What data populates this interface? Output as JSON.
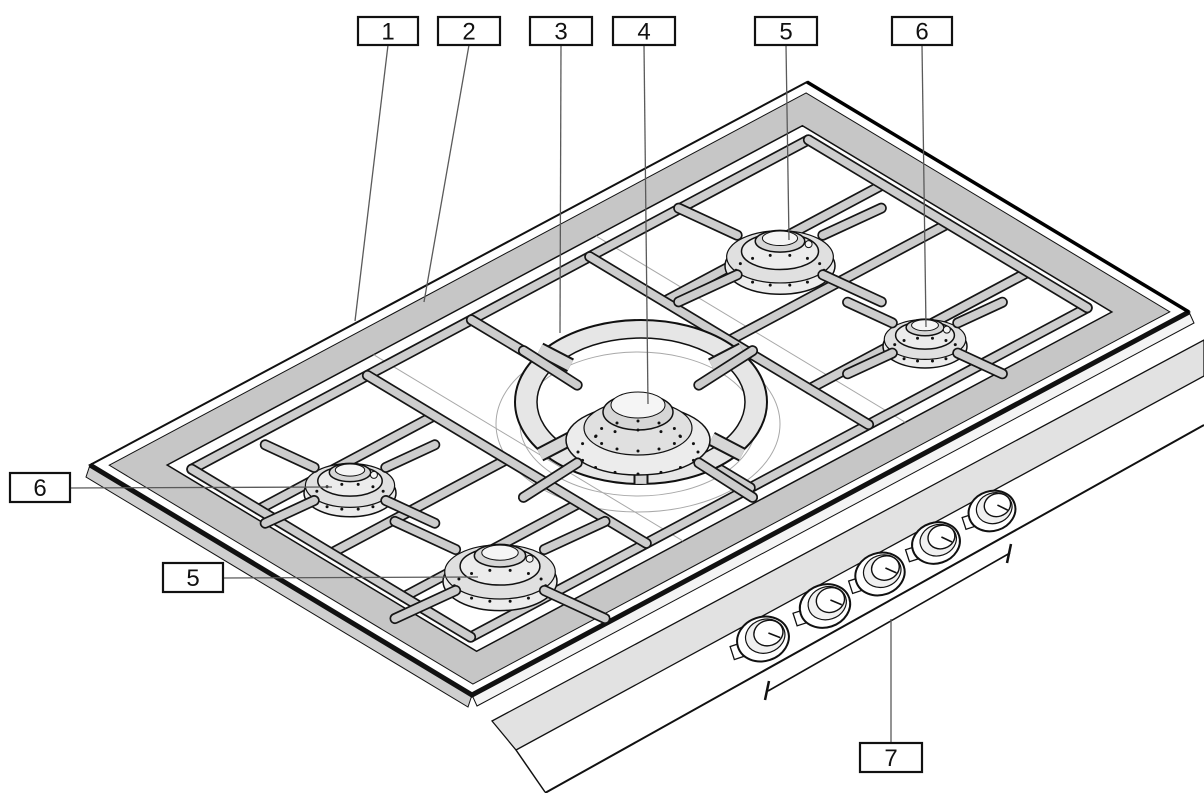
{
  "figure": {
    "subject": "gas cooktop parts diagram",
    "style": "black and white line illustration",
    "background_color": "#ffffff",
    "line_color": "#111111",
    "rim_color": "#c6c6c6",
    "grate_color": "#cdcdcd",
    "burner_count": 5,
    "knob_count": 5
  },
  "callouts": [
    {
      "label": "1",
      "box": {
        "x": 358,
        "y": 17,
        "w": 60,
        "h": 28
      },
      "leader": {
        "x1": 388,
        "y1": 45,
        "x2": 355,
        "y2": 321
      }
    },
    {
      "label": "2",
      "box": {
        "x": 438,
        "y": 17,
        "w": 62,
        "h": 28
      },
      "leader": {
        "x1": 469,
        "y1": 45,
        "x2": 424,
        "y2": 302
      }
    },
    {
      "label": "3",
      "box": {
        "x": 530,
        "y": 17,
        "w": 62,
        "h": 28
      },
      "leader": {
        "x1": 561,
        "y1": 45,
        "x2": 560,
        "y2": 333
      }
    },
    {
      "label": "4",
      "box": {
        "x": 613,
        "y": 17,
        "w": 62,
        "h": 28
      },
      "leader": {
        "x1": 644,
        "y1": 45,
        "x2": 648,
        "y2": 404
      }
    },
    {
      "label": "5",
      "box": {
        "x": 755,
        "y": 17,
        "w": 62,
        "h": 28
      },
      "leader": {
        "x1": 786,
        "y1": 45,
        "x2": 789,
        "y2": 240
      }
    },
    {
      "label": "6",
      "box": {
        "x": 892,
        "y": 17,
        "w": 60,
        "h": 28
      },
      "leader": {
        "x1": 922,
        "y1": 45,
        "x2": 926,
        "y2": 327
      }
    },
    {
      "label": "6",
      "box": {
        "x": 10,
        "y": 473,
        "w": 60,
        "h": 29
      },
      "leader": {
        "x1": 70,
        "y1": 488,
        "x2": 332,
        "y2": 487
      }
    },
    {
      "label": "5",
      "box": {
        "x": 163,
        "y": 563,
        "w": 60,
        "h": 29
      },
      "leader": {
        "x1": 223,
        "y1": 578,
        "x2": 478,
        "y2": 577
      }
    },
    {
      "label": "7",
      "box": {
        "x": 860,
        "y": 743,
        "w": 62,
        "h": 29
      },
      "leader": {
        "x1": 891,
        "y1": 743,
        "x2": 891,
        "y2": 619
      }
    }
  ]
}
